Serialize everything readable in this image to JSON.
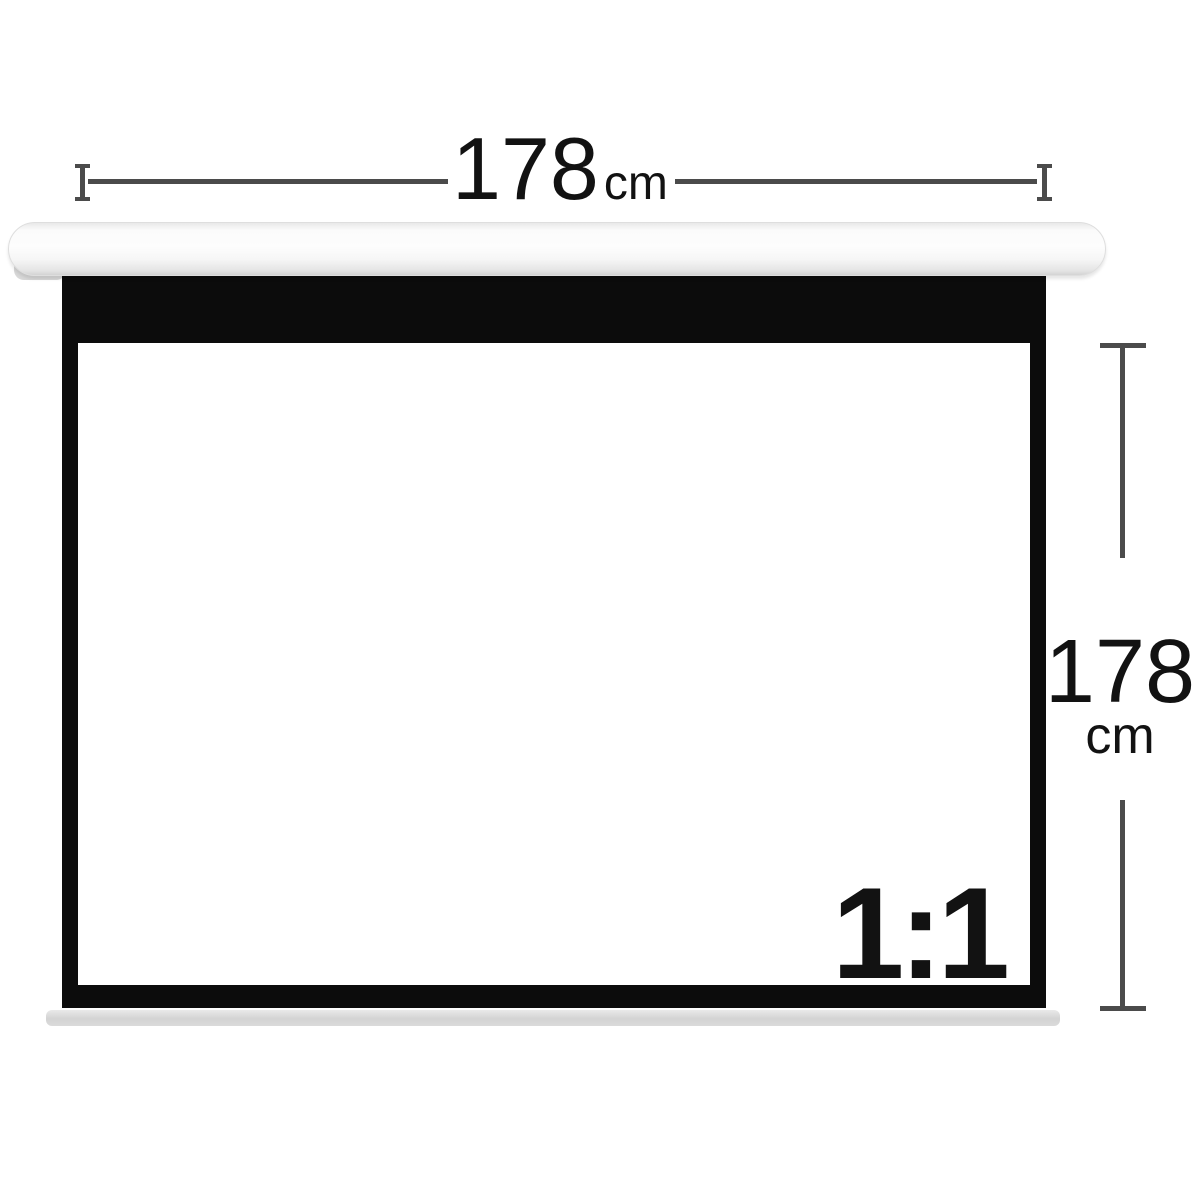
{
  "dimensions": {
    "width": {
      "value": "178",
      "unit": "cm"
    },
    "height": {
      "value": "178",
      "unit": "cm"
    }
  },
  "screen": {
    "aspect_ratio_label": "1:1"
  },
  "icons": {
    "tick_left": "i-beam-end-tick",
    "tick_right": "i-beam-end-tick",
    "tick_top": "t-bar-end-tick",
    "tick_bottom": "t-bar-end-tick"
  },
  "colors": {
    "background": "#ffffff",
    "dimension_line": "#4b4b4b",
    "text": "#121212",
    "frame_black": "#0c0c0c",
    "casing_white": "#fdfdfd",
    "slat_gray": "#d3d3d3"
  }
}
